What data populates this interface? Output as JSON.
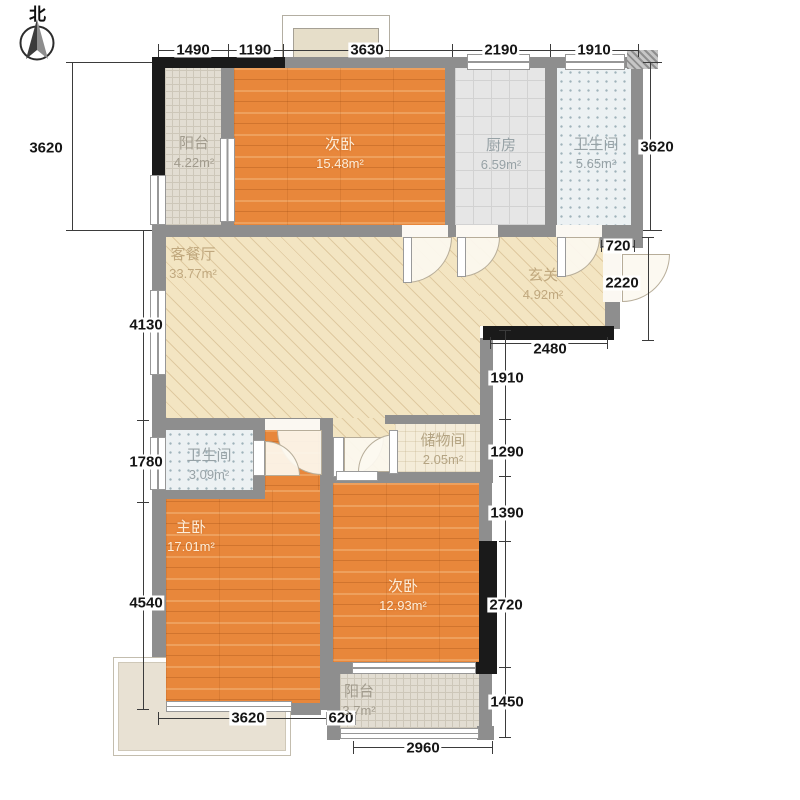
{
  "compass": {
    "label": "北"
  },
  "rooms": [
    {
      "name": "阳台",
      "area": "4.22m²"
    },
    {
      "name": "次卧",
      "area": "15.48m²"
    },
    {
      "name": "厨房",
      "area": "6.59m²"
    },
    {
      "name": "卫生间",
      "area": "5.65m²"
    },
    {
      "name": "客餐厅",
      "area": "33.77m²"
    },
    {
      "name": "玄关",
      "area": "4.92m²"
    },
    {
      "name": "卫生间",
      "area": "3.09m²"
    },
    {
      "name": "储物间",
      "area": "2.05m²"
    },
    {
      "name": "主卧",
      "area": "17.01m²"
    },
    {
      "name": "次卧",
      "area": "12.93m²"
    },
    {
      "name": "阳台",
      "area": "3.7m²"
    }
  ],
  "dimensions": {
    "top": [
      "1490",
      "1190",
      "3630",
      "2190",
      "1910"
    ],
    "left": [
      "3620",
      "4130",
      "1780",
      "4540"
    ],
    "right": [
      "3620",
      "720",
      "2220",
      "2480",
      "1910",
      "1290",
      "1390",
      "2720",
      "1450"
    ],
    "bottom": [
      "3620",
      "620",
      "2960"
    ]
  },
  "colors": {
    "wall": "#8e8e8e",
    "accent_wall": "#1a1a1a",
    "wood_floor": "#e8873b",
    "living_floor": "#f3e5c2"
  }
}
